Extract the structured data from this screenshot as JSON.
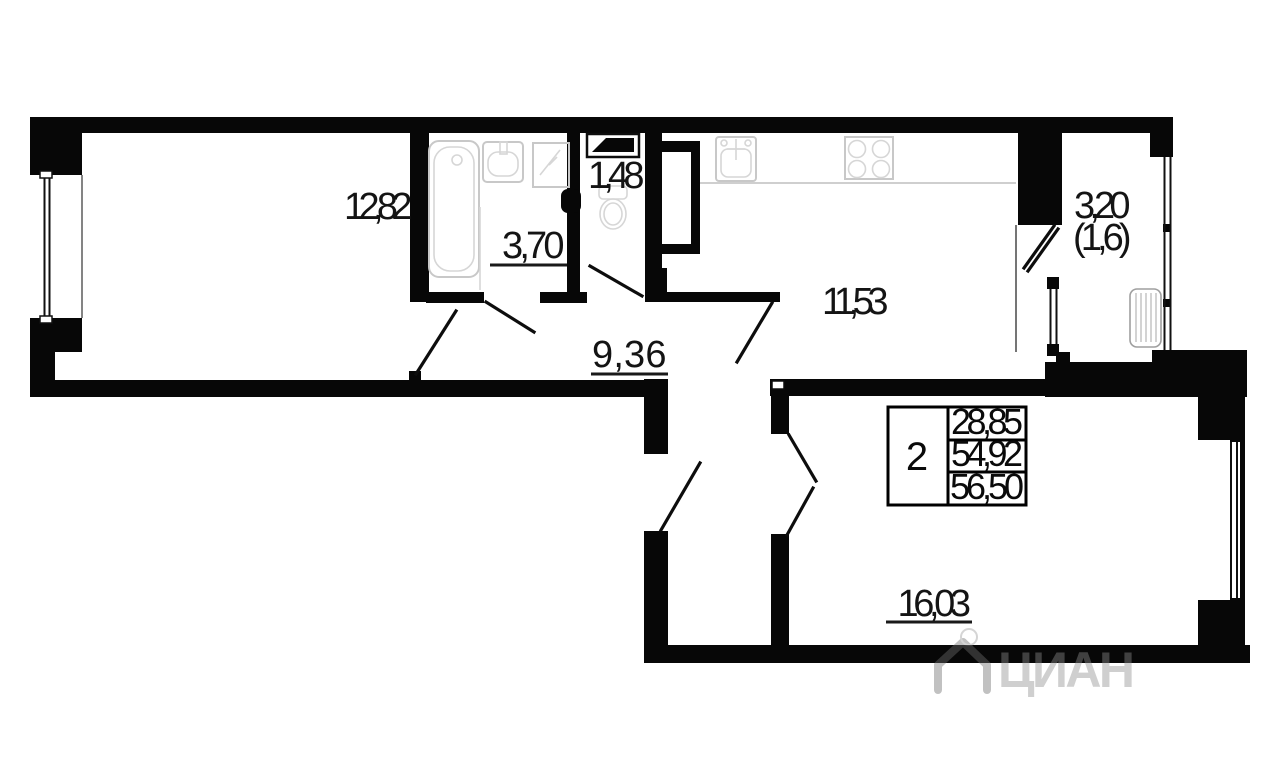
{
  "rooms": {
    "living": {
      "area": "12,82"
    },
    "bathroom": {
      "area": "3,70"
    },
    "wc": {
      "area": "1,48"
    },
    "kitchen": {
      "area": "11,53"
    },
    "hall": {
      "area": "9,36"
    },
    "bedroom": {
      "area": "16,03"
    },
    "loggia": {
      "area": "3,20",
      "area_reduced": "(1,6)"
    }
  },
  "info_table": {
    "rooms_count": "2",
    "rows": [
      "28,85",
      "54,92",
      "56,50"
    ]
  },
  "watermark": {
    "brand": "ЦИАН"
  },
  "colors": {
    "wall": "#070707",
    "fixture": "#c8c8c8",
    "watermark": "#8f8f8f"
  }
}
